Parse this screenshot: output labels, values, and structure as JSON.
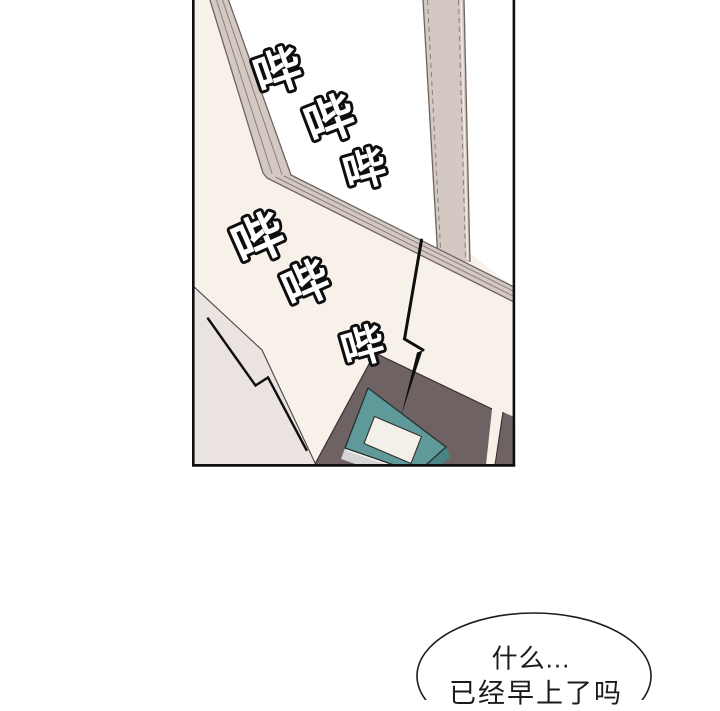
{
  "panel": {
    "type": "comic-panel",
    "description_visible_elements": "window with frame, wall, desk with teal alarm clock, sound bolts"
  },
  "sfx": {
    "beeps": [
      {
        "text": "哔"
      },
      {
        "text": "哔"
      },
      {
        "text": "哔"
      },
      {
        "text": "哔"
      },
      {
        "text": "哔"
      },
      {
        "text": "哔"
      }
    ]
  },
  "speech_bubble": {
    "line1": "什么...",
    "line2": "已经早上了吗"
  },
  "colors": {
    "page_bg": "#ffffff",
    "wall": "#f7f1e9",
    "window_pane": "#ffffff",
    "window_frame": "#d3c8c2",
    "frame_line": "#8a7f78",
    "frame_edge": "#6e645e",
    "lower_surface": "#eae3e0",
    "lower_surface_line": "#4a4442",
    "desk": "#6f6263",
    "clock_teal": "#5f999a",
    "clock_teal_dark": "#4a8484",
    "clock_front": "#d7d4d7",
    "clock_label": "#f3f0e9",
    "outline": "#37302e",
    "ink": "#0e0e0e"
  }
}
